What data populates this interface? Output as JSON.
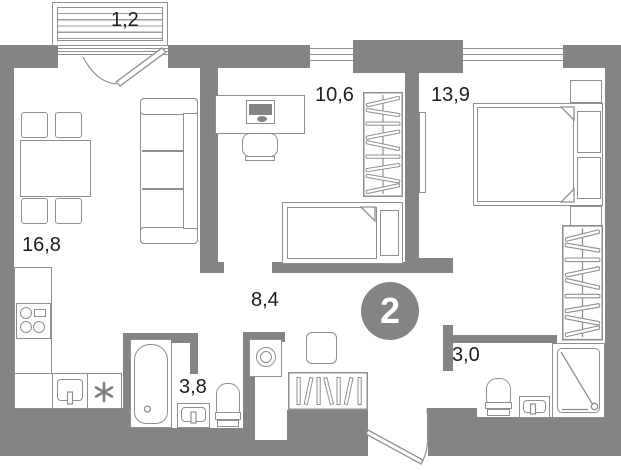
{
  "plan": {
    "type": "apartment-floor-plan",
    "badge": {
      "room_count": "2"
    },
    "rooms": [
      {
        "name": "balcony",
        "area": "1,2"
      },
      {
        "name": "living-kitchen",
        "area": "16,8"
      },
      {
        "name": "study",
        "area": "10,6"
      },
      {
        "name": "bedroom",
        "area": "13,9"
      },
      {
        "name": "hallway",
        "area": "8,4"
      },
      {
        "name": "bathroom",
        "area": "3,8"
      },
      {
        "name": "shower-wc",
        "area": "3,0"
      }
    ],
    "colors": {
      "wall": "#848484",
      "outline": "#8f8f8f",
      "text": "#1d1d1d",
      "background": "#ffffff",
      "badge_fill": "#848484",
      "badge_text": "#ffffff"
    },
    "icons": [
      "snowflake-asterisk-fridge",
      "room-count-badge"
    ]
  }
}
